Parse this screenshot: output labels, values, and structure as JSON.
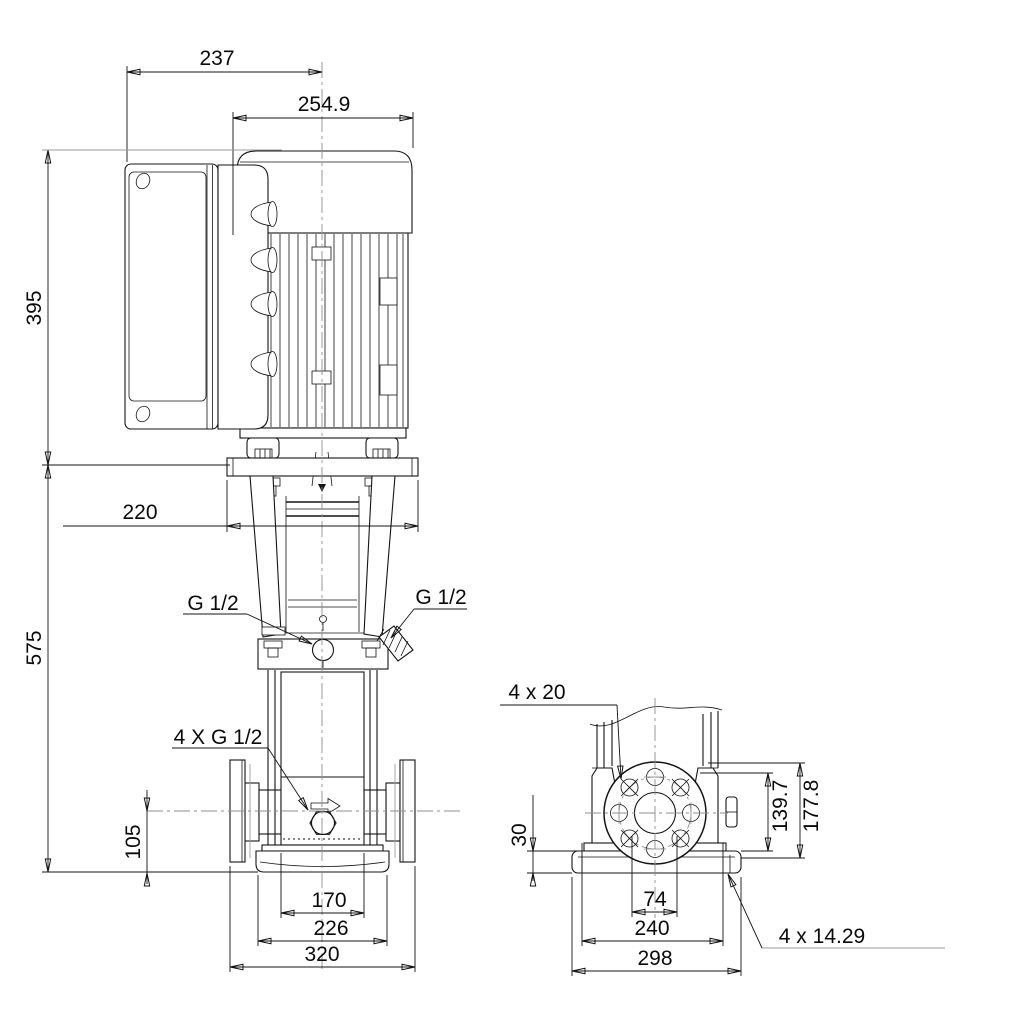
{
  "page": {
    "background": "#ffffff",
    "line_color": "#141414",
    "construction_gray": "#9b9b9b",
    "units": "mm"
  },
  "front_view": {
    "dims": {
      "control_box_width": "237",
      "motor_width": "254.9",
      "motor_height": "395",
      "pump_height": "575",
      "motor_stool_flange": "220",
      "gauge_port_left": "G 1/2",
      "gauge_port_right": "G 1/2",
      "gauge_ports": "4 X G 1/2",
      "port_centre_height": "105",
      "base_width_inner": "170",
      "base_width": "226",
      "port_to_port": "320"
    }
  },
  "side_view": {
    "dims": {
      "flange_bolt_holes": "4 x 20",
      "base_plate_height": "30",
      "flange_dim_inner": "139.7",
      "flange_dim_outer": "177.8",
      "foot_width_inner": "74",
      "base_bolt_spacing": "240",
      "base_plate_width": "298",
      "base_bolt_holes": "4 x 14.29"
    }
  }
}
